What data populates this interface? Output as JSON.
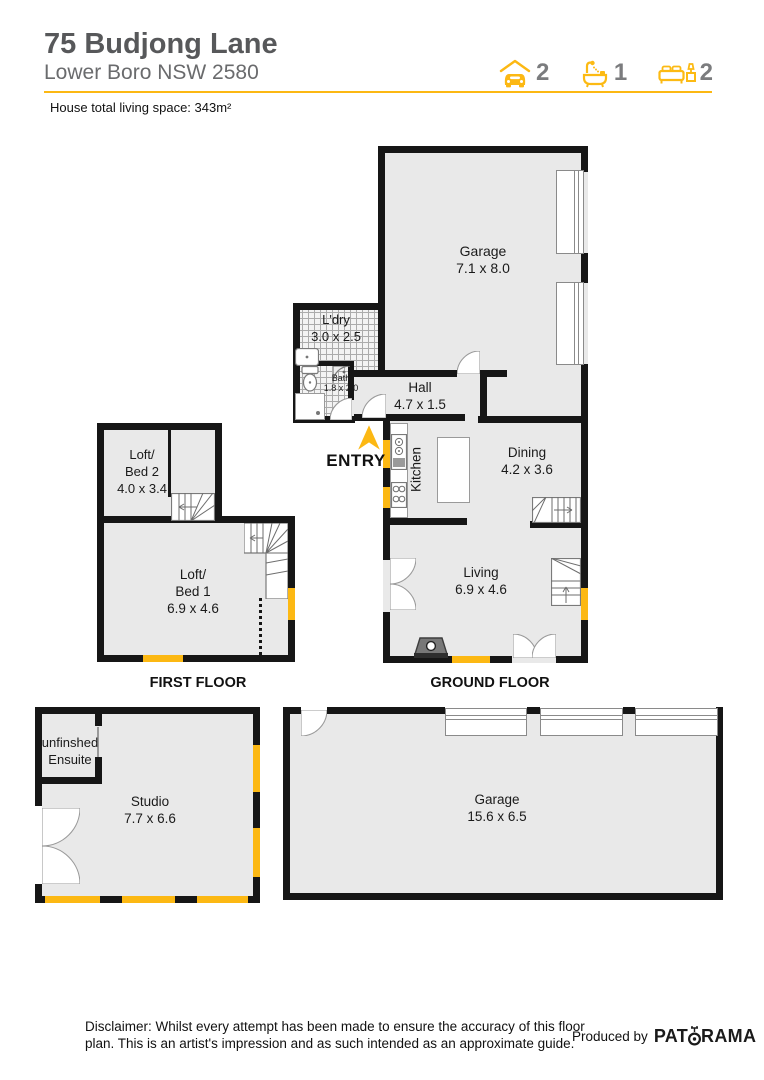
{
  "header": {
    "title": "75 Budjong Lane",
    "subtitle": "Lower Boro NSW 2580",
    "living_space": "House total living space: 343m²",
    "accent_color": "#FCB813",
    "stats": {
      "garages": {
        "icon": "garage-car-icon",
        "value": "2"
      },
      "baths": {
        "icon": "bathtub-icon",
        "value": "1"
      },
      "beds": {
        "icon": "bed-icon",
        "value": "2"
      }
    }
  },
  "plans": {
    "ground": {
      "floor_label": "GROUND FLOOR",
      "entry_label": "ENTRY",
      "rooms": {
        "garage": {
          "name": "Garage",
          "dims": "7.1 x 8.0"
        },
        "laundry": {
          "name": "L'dry",
          "dims": "3.0 x 2.5"
        },
        "bath": {
          "name": "Bath",
          "dims": "1.8 x 2.0"
        },
        "hall": {
          "name": "Hall",
          "dims": "4.7 x 1.5"
        },
        "kitchen": {
          "name": "Kitchen"
        },
        "dining": {
          "name": "Dining",
          "dims": "4.2 x 3.6"
        },
        "living": {
          "name": "Living",
          "dims": "6.9 x 4.6"
        }
      }
    },
    "first": {
      "floor_label": "FIRST FLOOR",
      "rooms": {
        "bed2": {
          "line1": "Loft/",
          "line2": "Bed 2",
          "dims": "4.0 x 3.4"
        },
        "bed1": {
          "line1": "Loft/",
          "line2": "Bed 1",
          "dims": "6.9 x 4.6"
        }
      }
    },
    "lower": {
      "rooms": {
        "ensuite": {
          "line1": "unfinshed",
          "line2": "Ensuite"
        },
        "studio": {
          "name": "Studio",
          "dims": "7.7 x 6.6"
        },
        "garage": {
          "name": "Garage",
          "dims": "15.6 x 6.5"
        }
      }
    }
  },
  "colors": {
    "wall": "#161616",
    "floor": "#e9e9e9",
    "window_marker": "#FCB813"
  },
  "footer": {
    "disclaimer_line1": "Disclaimer: Whilst every attempt has been made to ensure the accuracy of this floor",
    "disclaimer_line2": "plan. This is an artist's impression and as such intended as an approximate guide.",
    "produced_by": "Produced by",
    "brand": "PATORAMA"
  }
}
